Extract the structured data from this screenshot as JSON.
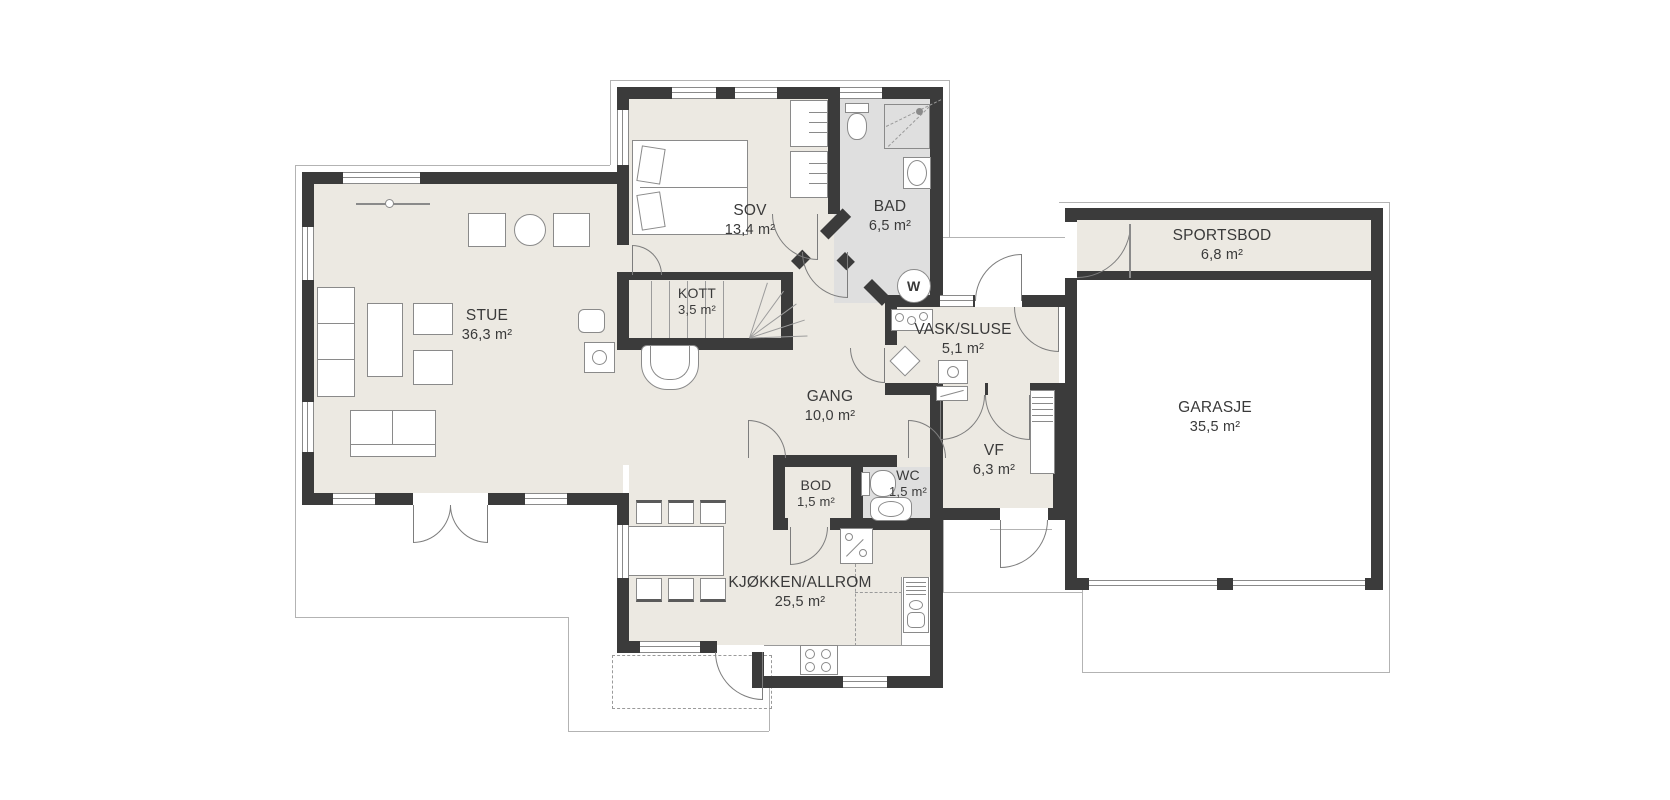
{
  "plan": {
    "type": "architectural-floor-plan",
    "rooms": [
      {
        "id": "stue",
        "name": "STUE",
        "area": "36,3 m²"
      },
      {
        "id": "sov",
        "name": "SOV",
        "area": "13,4 m²"
      },
      {
        "id": "bad",
        "name": "BAD",
        "area": "6,5 m²"
      },
      {
        "id": "kott",
        "name": "KOTT",
        "area": "3,5 m²"
      },
      {
        "id": "vask-sluse",
        "name": "VASK/SLUSE",
        "area": "5,1 m²"
      },
      {
        "id": "gang",
        "name": "GANG",
        "area": "10,0 m²"
      },
      {
        "id": "vf",
        "name": "VF",
        "area": "6,3 m²"
      },
      {
        "id": "bod",
        "name": "BOD",
        "area": "1,5 m²"
      },
      {
        "id": "wc",
        "name": "WC",
        "area": "1,5 m²"
      },
      {
        "id": "kjokken-allrom",
        "name": "KJØKKEN/ALLROM",
        "area": "25,5 m²"
      },
      {
        "id": "sportsbod",
        "name": "SPORTSBOD",
        "area": "6,8 m²"
      },
      {
        "id": "garasje",
        "name": "GARASJE",
        "area": "35,5 m²"
      }
    ],
    "appliance_labels": {
      "washing_machine": "W"
    },
    "colors": {
      "wall": "#3b3b3b",
      "floor": "#ece9e2",
      "wet_floor": "#dfdfdf",
      "outline": "#b3b3b3",
      "label": "#3a3a3a",
      "background": "#ffffff"
    }
  }
}
